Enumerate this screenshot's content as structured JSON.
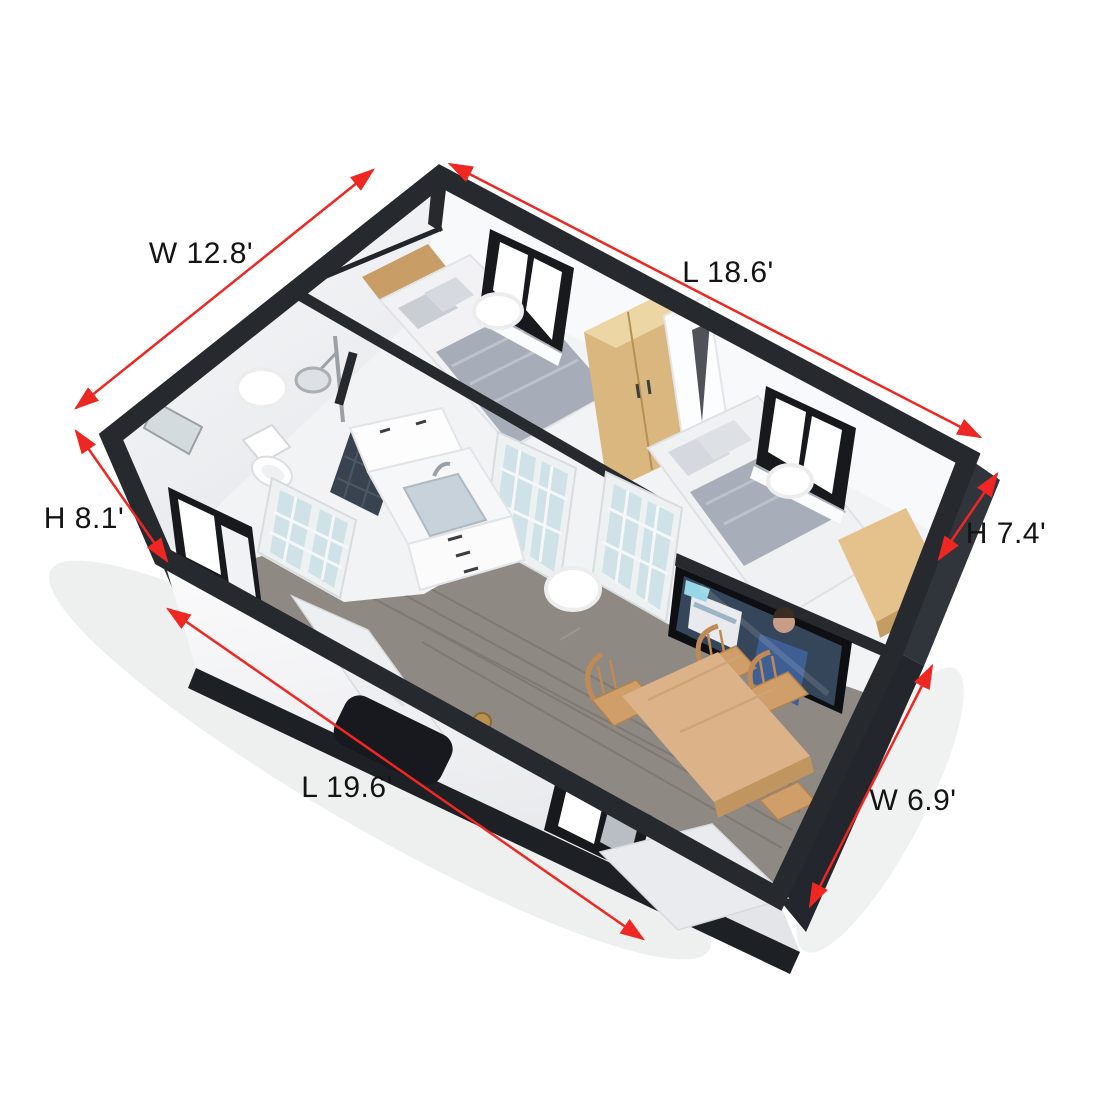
{
  "figure": {
    "subject": "Expandable container tiny house",
    "view": "3D aerial cutaway rendering with dimension annotations",
    "background": "#ffffff"
  },
  "annotations": {
    "arrow_color": "#ee2723",
    "text_color": "#141414",
    "dimensions": [
      {
        "id": "left-end-width",
        "label": "W 12.8'",
        "value": 12.8,
        "unit": "ft",
        "position": "top-left"
      },
      {
        "id": "back-side-length",
        "label": "L 18.6'",
        "value": 18.6,
        "unit": "ft",
        "position": "top-right"
      },
      {
        "id": "left-wall-height",
        "label": "H 8.1'",
        "value": 8.1,
        "unit": "ft",
        "position": "middle-left"
      },
      {
        "id": "right-wall-height",
        "label": "H 7.4'",
        "value": 7.4,
        "unit": "ft",
        "position": "middle-right"
      },
      {
        "id": "front-side-length",
        "label": "L 19.6'",
        "value": 19.6,
        "unit": "ft",
        "position": "bottom-left"
      },
      {
        "id": "right-wing-width",
        "label": "W 6.9'",
        "value": 6.9,
        "unit": "ft",
        "position": "bottom-right"
      }
    ]
  },
  "scene": {
    "rooms": [
      {
        "name": "bathroom",
        "items": [
          "toilet",
          "shower",
          "mirror",
          "dark-tile-shower-floor",
          "ceiling-light"
        ]
      },
      {
        "name": "bedroom-1",
        "items": [
          "double-bed",
          "wood-headboard",
          "pillows",
          "gray-duvet",
          "window",
          "wardrobe",
          "white-closet",
          "ceiling-light"
        ]
      },
      {
        "name": "bedroom-2",
        "items": [
          "double-bed",
          "pillows",
          "gray-blanket",
          "window",
          "wood-desk",
          "ceiling-light"
        ]
      },
      {
        "name": "hallway-kitchen",
        "items": [
          "vanity-sink-cabinet",
          "faucet",
          "french-glass-doors",
          "gray-wood-floor",
          "ceiling-light"
        ]
      },
      {
        "name": "dining-living",
        "items": [
          "dining-table",
          "wood-chairs",
          "wall-tv",
          "front-window"
        ]
      }
    ],
    "exterior": [
      "dark-steel-frame",
      "white-wall-panels",
      "front-sliding-window",
      "leaning-ramp-panel",
      "dark-entry-mat-panel",
      "brass-knob",
      "corner-skirt-panel"
    ]
  },
  "palette": {
    "frame_charcoal": "#26292e",
    "wall_white": "#f6f7f8",
    "floor_wood_gray": "#8e8983",
    "furniture_wood_tan": "#d9b77e",
    "door_glass_blue": "#cfe2e8",
    "bedding_gray": "#a7adb8",
    "annotation_red": "#ee2723"
  }
}
